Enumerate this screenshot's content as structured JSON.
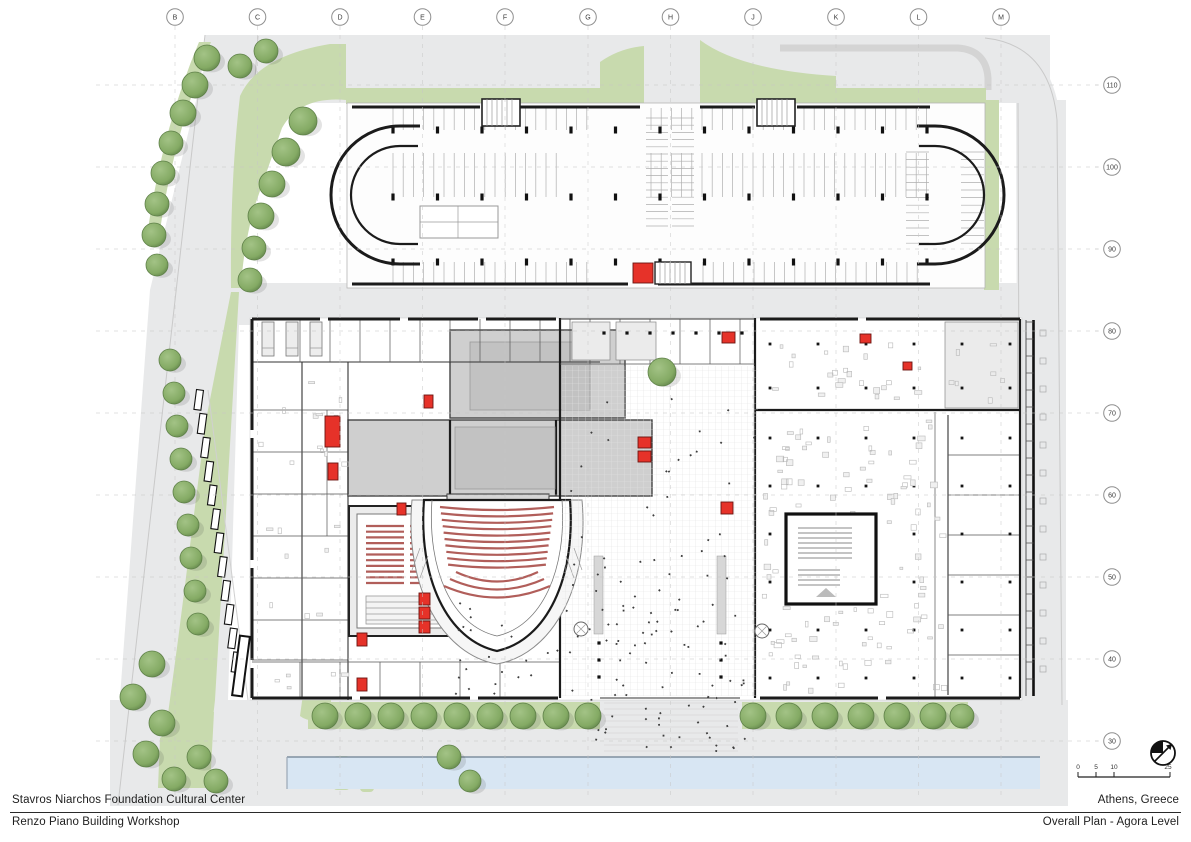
{
  "title_block": {
    "project": "Stavros Niarchos Foundation Cultural Center",
    "location": "Athens, Greece",
    "firm": "Renzo Piano Building Workshop",
    "sheet": "Overall Plan - Agora Level"
  },
  "grid": {
    "columns": [
      "B",
      "C",
      "D",
      "E",
      "F",
      "G",
      "H",
      "J",
      "K",
      "L",
      "M"
    ],
    "rows": [
      "110",
      "100",
      "90",
      "80",
      "70",
      "60",
      "50",
      "40",
      "30"
    ]
  },
  "scale_bar": {
    "labels": [
      "0",
      "5",
      "10",
      "25"
    ]
  },
  "icons": {
    "north_arrow": "north-arrow-icon"
  },
  "colors": {
    "paper": "#ffffff",
    "road": "#e8e9ea",
    "green": "#c8daae",
    "green_dark": "#b3cc94",
    "tree_fill": "#84aa64",
    "tree_light": "#a3c386",
    "tree_edge": "#5f8149",
    "water": "#d8e6f3",
    "wall": "#1b1b1b",
    "stage_gray": "#cfcfcf",
    "stage_gray_dark": "#c2c2c2",
    "seat_red": "#b15e5a",
    "accent_red": "#e63229",
    "grid_line": "#c6c6c6"
  }
}
